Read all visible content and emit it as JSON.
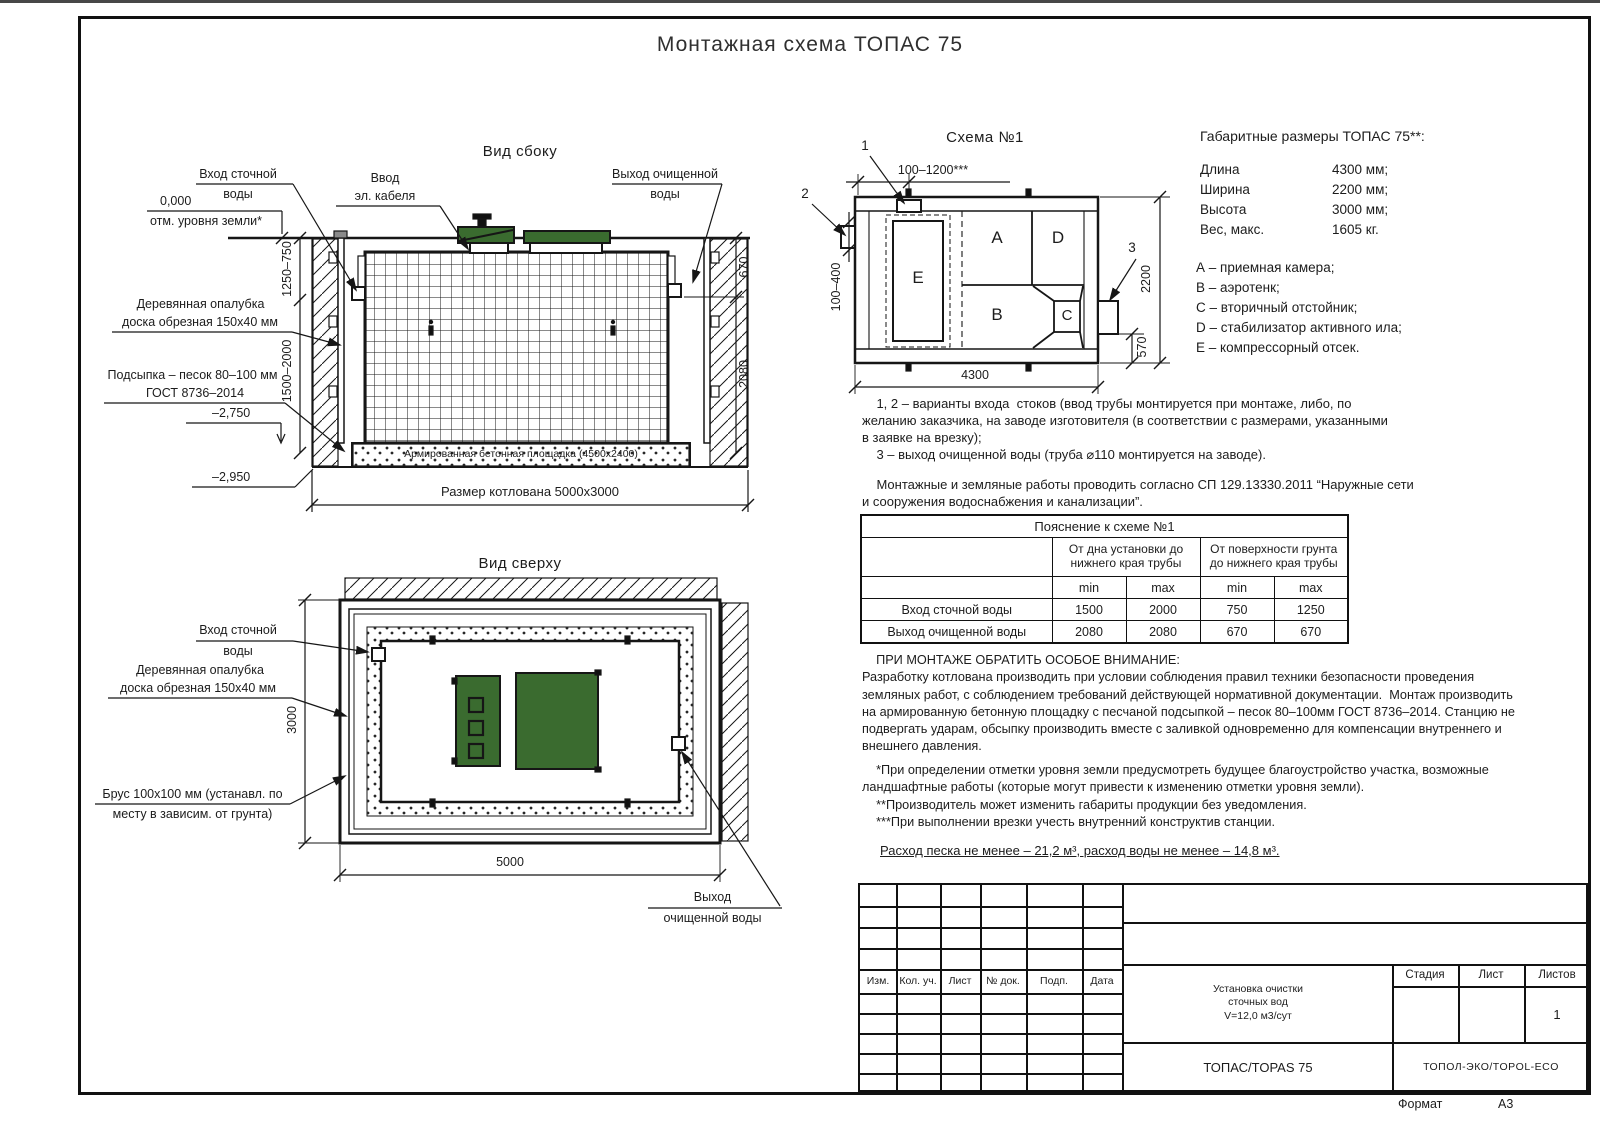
{
  "page": {
    "title": "Монтажная схема ТОПАС 75",
    "format_label": "Формат",
    "format_value": "А3"
  },
  "colors": {
    "lid_green": "#3a6b2f",
    "line": "#161616"
  },
  "side": {
    "title": "Вид сбоку",
    "labels": {
      "inlet1": "Вход сточной",
      "inlet2": "воды",
      "cable1": "Ввод",
      "cable2": "эл. кабеля",
      "outlet1": "Выход очищенной",
      "outlet2": "воды",
      "zero": "0,000",
      "ground": "отм. уровня земли*",
      "formwork1": "Деревянная опалубка",
      "formwork2": "доска обрезная 150х40 мм",
      "bedding1": "Подсыпка – песок 80–100 мм",
      "bedding2": "ГОСТ 8736–2014",
      "lvl2750": "–2,750",
      "lvl2950": "–2,950",
      "slab": "Армированная бетонная площадка (4500х2400)",
      "pit": "Размер котлована 5000х3000"
    },
    "dims": {
      "d1": "1250–750",
      "d2": "1500–2000",
      "d3": "670",
      "d4": "2080"
    }
  },
  "top": {
    "title": "Вид сверху",
    "labels": {
      "inlet1": "Вход сточной",
      "inlet2": "воды",
      "formwork1": "Деревянная опалубка",
      "formwork2": "доска обрезная 150х40 мм",
      "beam1": "Брус 100х100 мм (устанавл. по",
      "beam2": "месту в зависим. от грунта)",
      "outlet1": "Выход",
      "outlet2": "очищенной воды"
    },
    "dims": {
      "d3000": "3000",
      "d5000": "5000"
    }
  },
  "schema": {
    "title": "Схема №1",
    "letters": {
      "a": "A",
      "b": "B",
      "c": "C",
      "d": "D",
      "e": "E"
    },
    "callouts": {
      "c1": "1",
      "c2": "2",
      "c3": "3"
    },
    "dims": {
      "top": "100–1200***",
      "left": "100–400",
      "right": "2200",
      "out": "570",
      "bottom": "4300"
    }
  },
  "specs": {
    "title": "Габаритные размеры ТОПАС 75**:",
    "rows": [
      {
        "label": "Длина",
        "value": "4300 мм;"
      },
      {
        "label": "Ширина",
        "value": "2200 мм;"
      },
      {
        "label": "Высота",
        "value": "3000 мм;"
      },
      {
        "label": "Вес, макс.",
        "value": "1605 кг."
      }
    ],
    "legend": [
      "А – приемная камера;",
      "В – аэротенк;",
      "С – вторичный отстойник;",
      "D – стабилизатор активного ила;",
      "Е – компрессорный отсек."
    ]
  },
  "notes": {
    "variants": "    1, 2 – варианты входа  стоков (ввод трубы монтируется при монтаже, либо, по\nжеланию заказчика, на заводе изготовителя (в соответствии с размерами, указанными\nв заявке на врезку);\n    3 – выход очищенной воды (труба ⌀110 монтируется на заводе).",
    "sp": "    Монтажные и земляные работы проводить согласно СП 129.13330.2011 “Наружные сети\nи сооружения водоснабжения и канализации”."
  },
  "table": {
    "title": "Пояснение к схеме №1",
    "group1": "От дна установки до\nнижнего края трубы",
    "group2": "От поверхности грунта\nдо нижнего края трубы",
    "min": "min",
    "max": "max",
    "rows": [
      {
        "label": "Вход сточной воды",
        "v": [
          "1500",
          "2000",
          "750",
          "1250"
        ]
      },
      {
        "label": "Выход очищенной воды",
        "v": [
          "2080",
          "2080",
          "670",
          "670"
        ]
      }
    ]
  },
  "attention": {
    "text": "    ПРИ МОНТАЖЕ ОБРАТИТЬ ОСОБОЕ ВНИМАНИЕ:\nРазработку котлована производить при условии соблюдения правил техники безопасности проведения\nземляных работ, с соблюдением требований действующей нормативной документации.  Монтаж производить\nна армированную бетонную площадку с песчаной подсыпкой – песок 80–100мм ГОСТ 8736–2014. Станцию не\nподвергать ударам, обсыпку производить вместе с заливкой одновременно для компенсации внутреннего и\nвнешнего давления.",
    "footnotes": "    *При определении отметки уровня земли предусмотреть будущее благоустройство участка, возможные\nландшафтные работы (которые могут привести к изменению отметки уровня земли).\n    **Производитель может изменить габариты продукции без уведомления.\n    ***При выполнении врезки учесть внутренний конструктив станции.",
    "consumption": "Расход песка не менее – 21,2 м³, расход воды не менее – 14,8 м³."
  },
  "stamp": {
    "rev": [
      "Изм.",
      "Кол. уч.",
      "Лист",
      "№ док.",
      "Подп.",
      "Дата"
    ],
    "doc_title": "Установка очистки\nсточных вод\nV=12,0 м3/сут",
    "stage": "Стадия",
    "sheet": "Лист",
    "sheets": "Листов",
    "sheets_value": "1",
    "product": "ТОПАС/TOPAS 75",
    "company": "ТОПОЛ-ЭКО/TOPOL-ECO"
  }
}
